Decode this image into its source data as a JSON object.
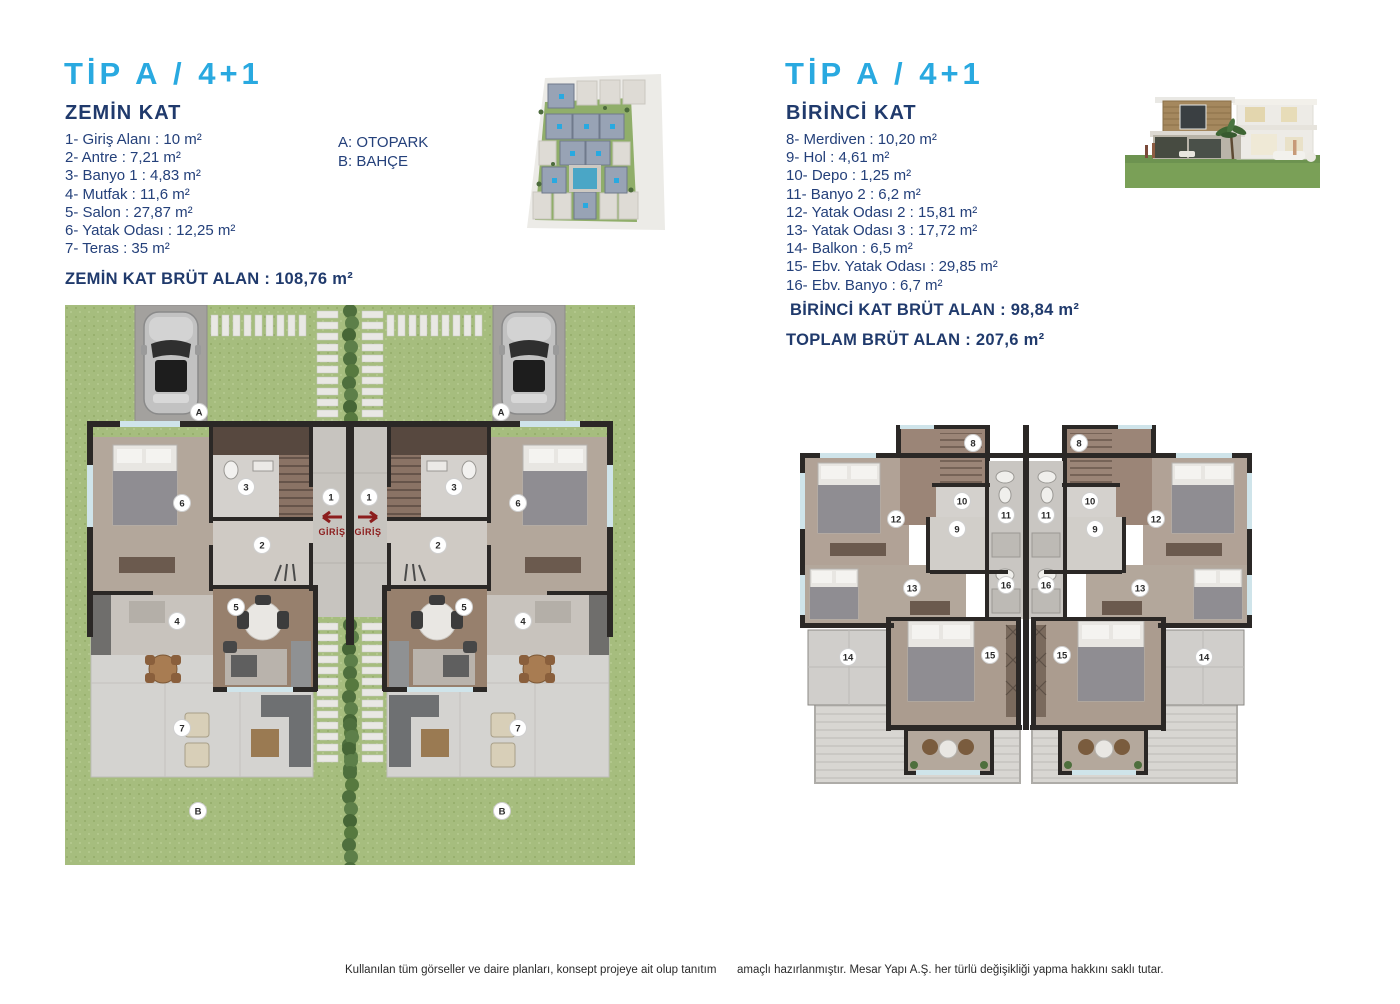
{
  "zemin": {
    "title": "TİP A / 4+1",
    "subtitle": "ZEMİN KAT",
    "rooms": [
      "1- Giriş Alanı : 10 m²",
      "2- Antre : 7,21 m²",
      "3- Banyo 1 : 4,83 m²",
      "4- Mutfak : 11,6 m²",
      "5- Salon : 27,87 m²",
      "6- Yatak Odası : 12,25 m²",
      "7- Teras : 35 m²"
    ],
    "legend": [
      "A: OTOPARK",
      "B: BAHÇE"
    ],
    "brut": "ZEMİN KAT BRÜT ALAN : 108,76 m²"
  },
  "birinci": {
    "title": "TİP A / 4+1",
    "subtitle": "BİRİNCİ KAT",
    "rooms": [
      "8- Merdiven : 10,20 m²",
      "9- Hol : 4,61 m²",
      "10- Depo : 1,25 m²",
      "11- Banyo 2 : 6,2 m²",
      "12- Yatak Odası 2 : 15,81 m²",
      "13- Yatak Odası 3 : 17,72 m²",
      "14- Balkon : 6,5 m²",
      "15- Ebv. Yatak Odası : 29,85 m²",
      "16- Ebv. Banyo : 6,7 m²"
    ],
    "brut": "BİRİNCİ KAT BRÜT ALAN : 98,84 m²",
    "toplam": "TOPLAM BRÜT ALAN : 207,6 m²"
  },
  "plan_labels": {
    "giris": "GİRİŞ",
    "parking": "A",
    "garden": "B",
    "r1": "1",
    "r2": "2",
    "r3": "3",
    "r4": "4",
    "r5": "5",
    "r6": "6",
    "r7": "7",
    "r8": "8",
    "r9": "9",
    "r10": "10",
    "r11": "11",
    "r12": "12",
    "r13": "13",
    "r14": "14",
    "r15": "15",
    "r16": "16"
  },
  "footer": {
    "left": "Kullanılan tüm görseller ve daire planları, konsept projeye ait olup tanıtım",
    "right": "amaçlı hazırlanmıştır. Mesar Yapı A.Ş. her türlü değişikliği yapma hakkını saklı tutar."
  },
  "colors": {
    "accent_cyan": "#29a9e0",
    "navy": "#203a6c",
    "grass": "#a6bd7e",
    "wall": "#2b2826",
    "giris_red": "#8c1d1d"
  }
}
